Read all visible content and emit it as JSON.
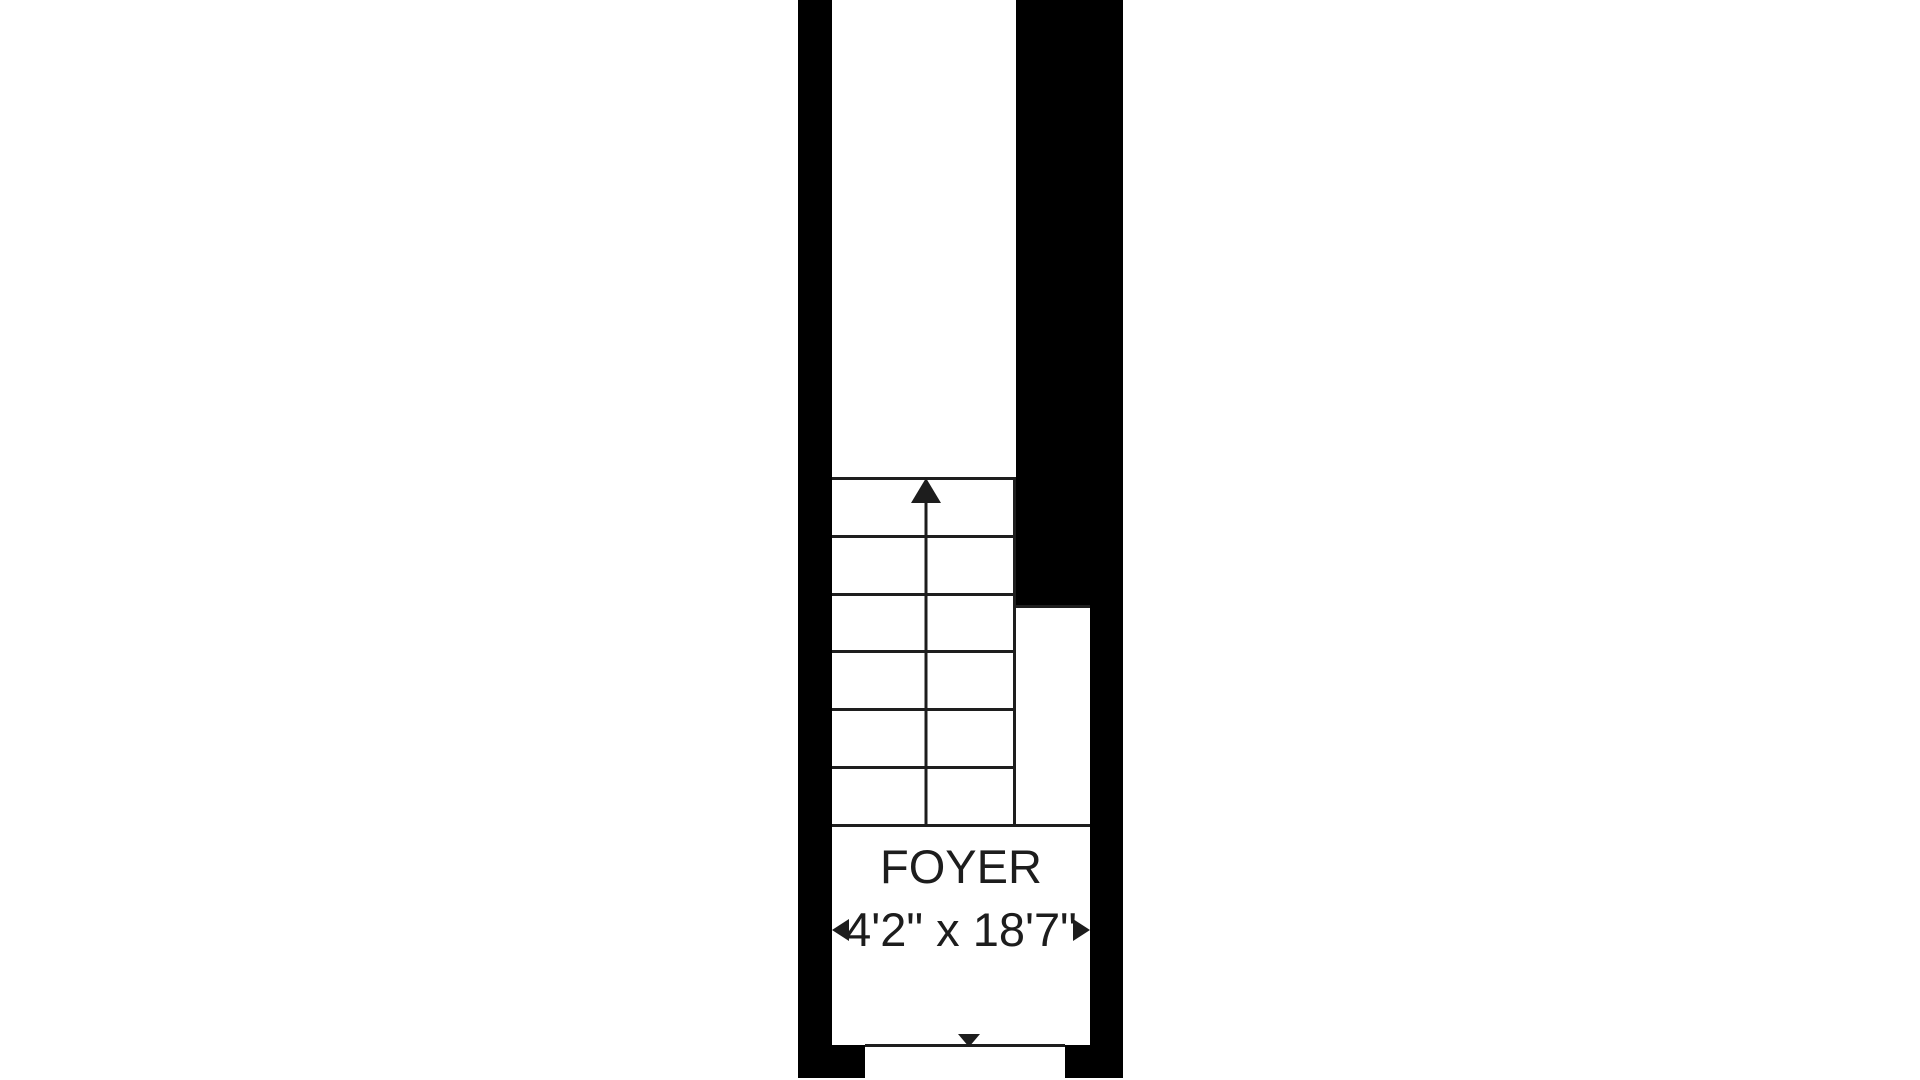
{
  "floor_plan": {
    "room": {
      "name": "FOYER",
      "dimensions": "4'2\" x 18'7\""
    },
    "stairs": {
      "steps": 6,
      "direction": "up"
    },
    "entry": {
      "direction": "down"
    },
    "colors": {
      "wall": "#000000",
      "line": "#1e1e1e",
      "text": "#1d1d1d",
      "background": "#ffffff"
    }
  }
}
